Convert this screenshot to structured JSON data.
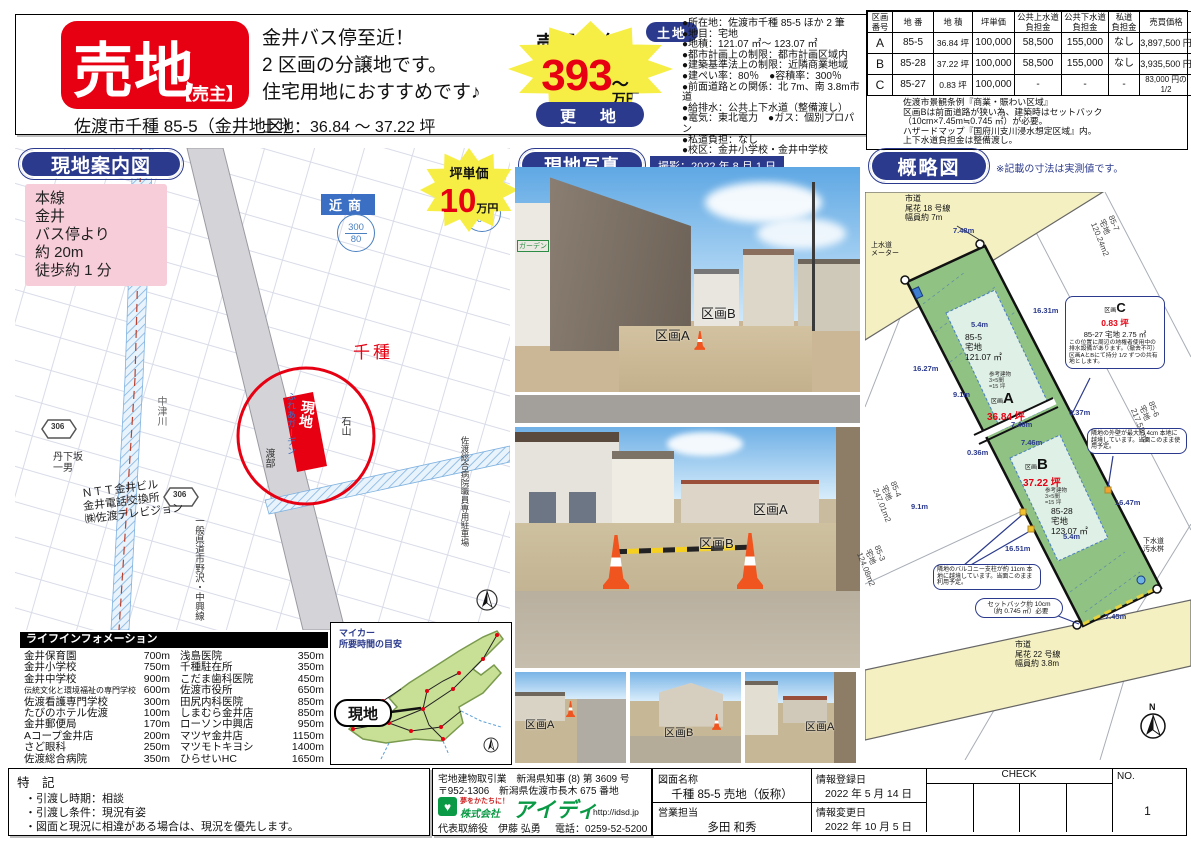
{
  "colors": {
    "accent_red": "#e60012",
    "navy": "#2b3a8c",
    "burst_yellow": "#f7ee45",
    "parcel_green": "#90c283",
    "road_yellow": "#f4f0c2",
    "map_pink": "#f6cdd9",
    "logo_green": "#0a9944"
  },
  "header": {
    "title": "売地",
    "seller_tag": "【売主】",
    "address": "佐渡市千種 85-5（金井地区）",
    "catch1": "金井バス停至近！",
    "catch2": "2 区画の分譲地です。",
    "catch3": "住宅用地におすすめです♪",
    "land_area": "土地：36.84 ～ 37.22 坪",
    "price_caption": "売買価格",
    "price_number": "393",
    "price_suffix": "～",
    "price_unit": "万円",
    "status_pill": "更　地",
    "land_pill": "土地",
    "details": [
      "●所在地：佐渡市千種 85-5 ほか 2 筆",
      "●地目：宅地",
      "●地積：121.07 ㎡～ 123.07 ㎡",
      "●都市計画上の制限：都市計画区域内",
      "●建築基準法上の制限：近隣商業地域",
      "●建ぺい率：80％　●容積率：300％",
      "●前面道路との関係：北 7m、南 3.8m市道",
      "●給排水：公共上下水道（整備渡し）",
      "●電気：東北電力　●ガス：個別プロパン",
      "●私道負担：なし",
      "●校区：金井小学校・金井中学校"
    ]
  },
  "price_table": {
    "headers": [
      "区画\n番号",
      "地 番",
      "地 積",
      "坪単価",
      "公共上水道\n負担金",
      "公共下水道\n負担金",
      "私道\n負担金",
      "売買価格"
    ],
    "rows": [
      [
        "A",
        "85-5",
        "36.84 坪",
        "100,000",
        "58,500",
        "155,000",
        "なし",
        "3,897,500 円"
      ],
      [
        "B",
        "85-28",
        "37.22 坪",
        "100,000",
        "58,500",
        "155,000",
        "なし",
        "3,935,500 円"
      ],
      [
        "C",
        "85-27",
        "0.83 坪",
        "100,000",
        "-",
        "-",
        "-",
        "83,000 円の 1/2"
      ]
    ],
    "notes": [
      "佐渡市景観条例『商業・賑わい区域』",
      "区画Bは前面道路が狭い為、建築時はセットバック",
      "（10cm×7.45m≒0.745 ㎡）が必要。",
      "ハザードマップ『国府川支川浸水想定区域』内。",
      "上下水道負担金は整備渡し。"
    ]
  },
  "guide_map": {
    "title": "現地案内図",
    "access": "本線\n金井\nバス停より\n約 20m\n徒歩約 1 分",
    "site_label": "現地",
    "town_label": "千種",
    "river_label": "中津川",
    "zone_label": "近商",
    "z1a": "300",
    "z1b": "80",
    "z2a": "200",
    "z2b": "60",
    "route_badge": "306",
    "ntt": "ＮＴＴ金井ビル\n金井電話交換所\n㈱佐渡テレビジョン",
    "road_label": "一般県道市野沢・中興線",
    "name_garden": "ふれあガーデン",
    "name_ishiyama": "石山",
    "name_watabe": "渡部",
    "name_tange": "丹下坂\n一男",
    "parking_label": "佐渡総合病院職員専用駐車場",
    "up_caption": "坪単価",
    "up_number": "10",
    "up_unit": "万円"
  },
  "life_info": {
    "title": "ライフインフォメーション",
    "left": [
      [
        "金井保育園",
        "700m"
      ],
      [
        "金井小学校",
        "750m"
      ],
      [
        "金井中学校",
        "900m"
      ],
      [
        "伝統文化と環境福祉の専門学校",
        "600m"
      ],
      [
        "佐渡看護専門学校",
        "300m"
      ],
      [
        "たびのホテル佐渡",
        "100m"
      ],
      [
        "金井郵便局",
        "170m"
      ],
      [
        "Aコープ金井店",
        "200m"
      ],
      [
        "さど眼科",
        "250m"
      ],
      [
        "佐渡総合病院",
        "350m"
      ]
    ],
    "right": [
      [
        "浅島医院",
        "350m"
      ],
      [
        "千種駐在所",
        "350m"
      ],
      [
        "こだま歯科医院",
        "450m"
      ],
      [
        "佐渡市役所",
        "650m"
      ],
      [
        "田尻内科医院",
        "850m"
      ],
      [
        "しまむら金井店",
        "850m"
      ],
      [
        "ローソン中興店",
        "950m"
      ],
      [
        "マツヤ金井店",
        "1150m"
      ],
      [
        "マツモトキヨシ",
        "1400m"
      ],
      [
        "ひらせいHC",
        "1650m"
      ]
    ]
  },
  "drive_map": {
    "title": "マイカー\n所要時間の目安",
    "site_label": "現地"
  },
  "photos": {
    "title": "現地写真",
    "shot_date": "撮影：2022 年 8 月 1 日",
    "p1_sign": "ガーデン",
    "p1a": "区画A",
    "p1b": "区画B",
    "p2a": "区画A",
    "p2b": "区画B",
    "s1": "区画A",
    "s2": "区画B",
    "s3": "区画A"
  },
  "sketch": {
    "title": "概略図",
    "note": "※記載の寸法は実測値です。",
    "road_top": "市道\n尾花 18 号線\n幅員約 7m",
    "road_bottom": "市道\n尾花 22 号線\n幅員約 3.8m",
    "water_meter": "上水道\nメーター",
    "sewer": "下水道\n汚水桝",
    "a_lot": "85-5\n宅地\n121.07 ㎡",
    "a_ref": "参考建物\n3×5間\n=15 坪",
    "a_tag": "区画",
    "a_letter": "A",
    "a_tsubo": "36.84 坪",
    "b_tag": "区画",
    "b_letter": "B",
    "b_tsubo": "37.22 坪",
    "b_ref": "参考建物\n3×5間\n=15 坪",
    "b_lot": "85-28\n宅地\n123.07 ㎡",
    "c_tag": "区画",
    "c_letter": "C",
    "c_tsubo": "0.83 坪",
    "c_lot": "85-27 宅地 2.75 ㎡",
    "c_body": "この位置に周辺の地権者使用中の排水設備があります。（撤去不可）区画AとBにて持分 1/2 ずつの共有地とします。",
    "wall": "隣地の外壁が最大約 4cm 本地に越境しています。当面このまま使用予定。",
    "balcony": "隣地のバルコニー支柱が約 11cm 本地に越境しています。当面このまま利用予定。",
    "setback": "セットバック約 10cm\n（約 0.745 ㎡）必要",
    "dims": [
      "7.48m",
      "16.31m",
      "16.27m",
      "5.4m",
      "9.1m",
      "7.46m",
      "7.46m",
      "0.37m",
      "0.36m",
      "9.1m",
      "5.4m",
      "16.51m",
      "16.47m",
      "7.45m"
    ],
    "neighbors": [
      "85-7\n宅地\n120.24m2",
      "85-6\n宅地\n217.52m2",
      "85-4\n宅地\n247.01m2",
      "85-3\n宅地\n124.08m2"
    ],
    "compass": "N"
  },
  "footer": {
    "tokki_title": "特　記",
    "tokki": [
      "・引渡し時期：相談",
      "・引渡し条件：現況有姿",
      "・図面と現況に相違がある場合は、現況を優先します。"
    ],
    "license1": "宅地建物取引業　新潟県知事 (8) 第 3609 号",
    "license2": "〒952-1306　新潟県佐渡市長木 675 番地",
    "tagline": "夢をかたちに！",
    "company_prefix": "株式会社",
    "company_name": "アイディ",
    "url": "http://idsd.jp",
    "rep": "代表取締役　伊藤 弘勇",
    "tel": "電話：0259-52-5200",
    "drawing_label": "図面名称",
    "drawing_value": "千種 85-5 売地（仮称）",
    "sales_label": "営業担当",
    "sales_value": "多田 和秀",
    "reg_label": "情報登録日",
    "reg_value": "2022 年 5 月 14 日",
    "chg_label": "情報変更日",
    "chg_value": "2022 年 10 月 5 日",
    "check_label": "CHECK",
    "no_label": "NO.",
    "no_value": "1"
  }
}
